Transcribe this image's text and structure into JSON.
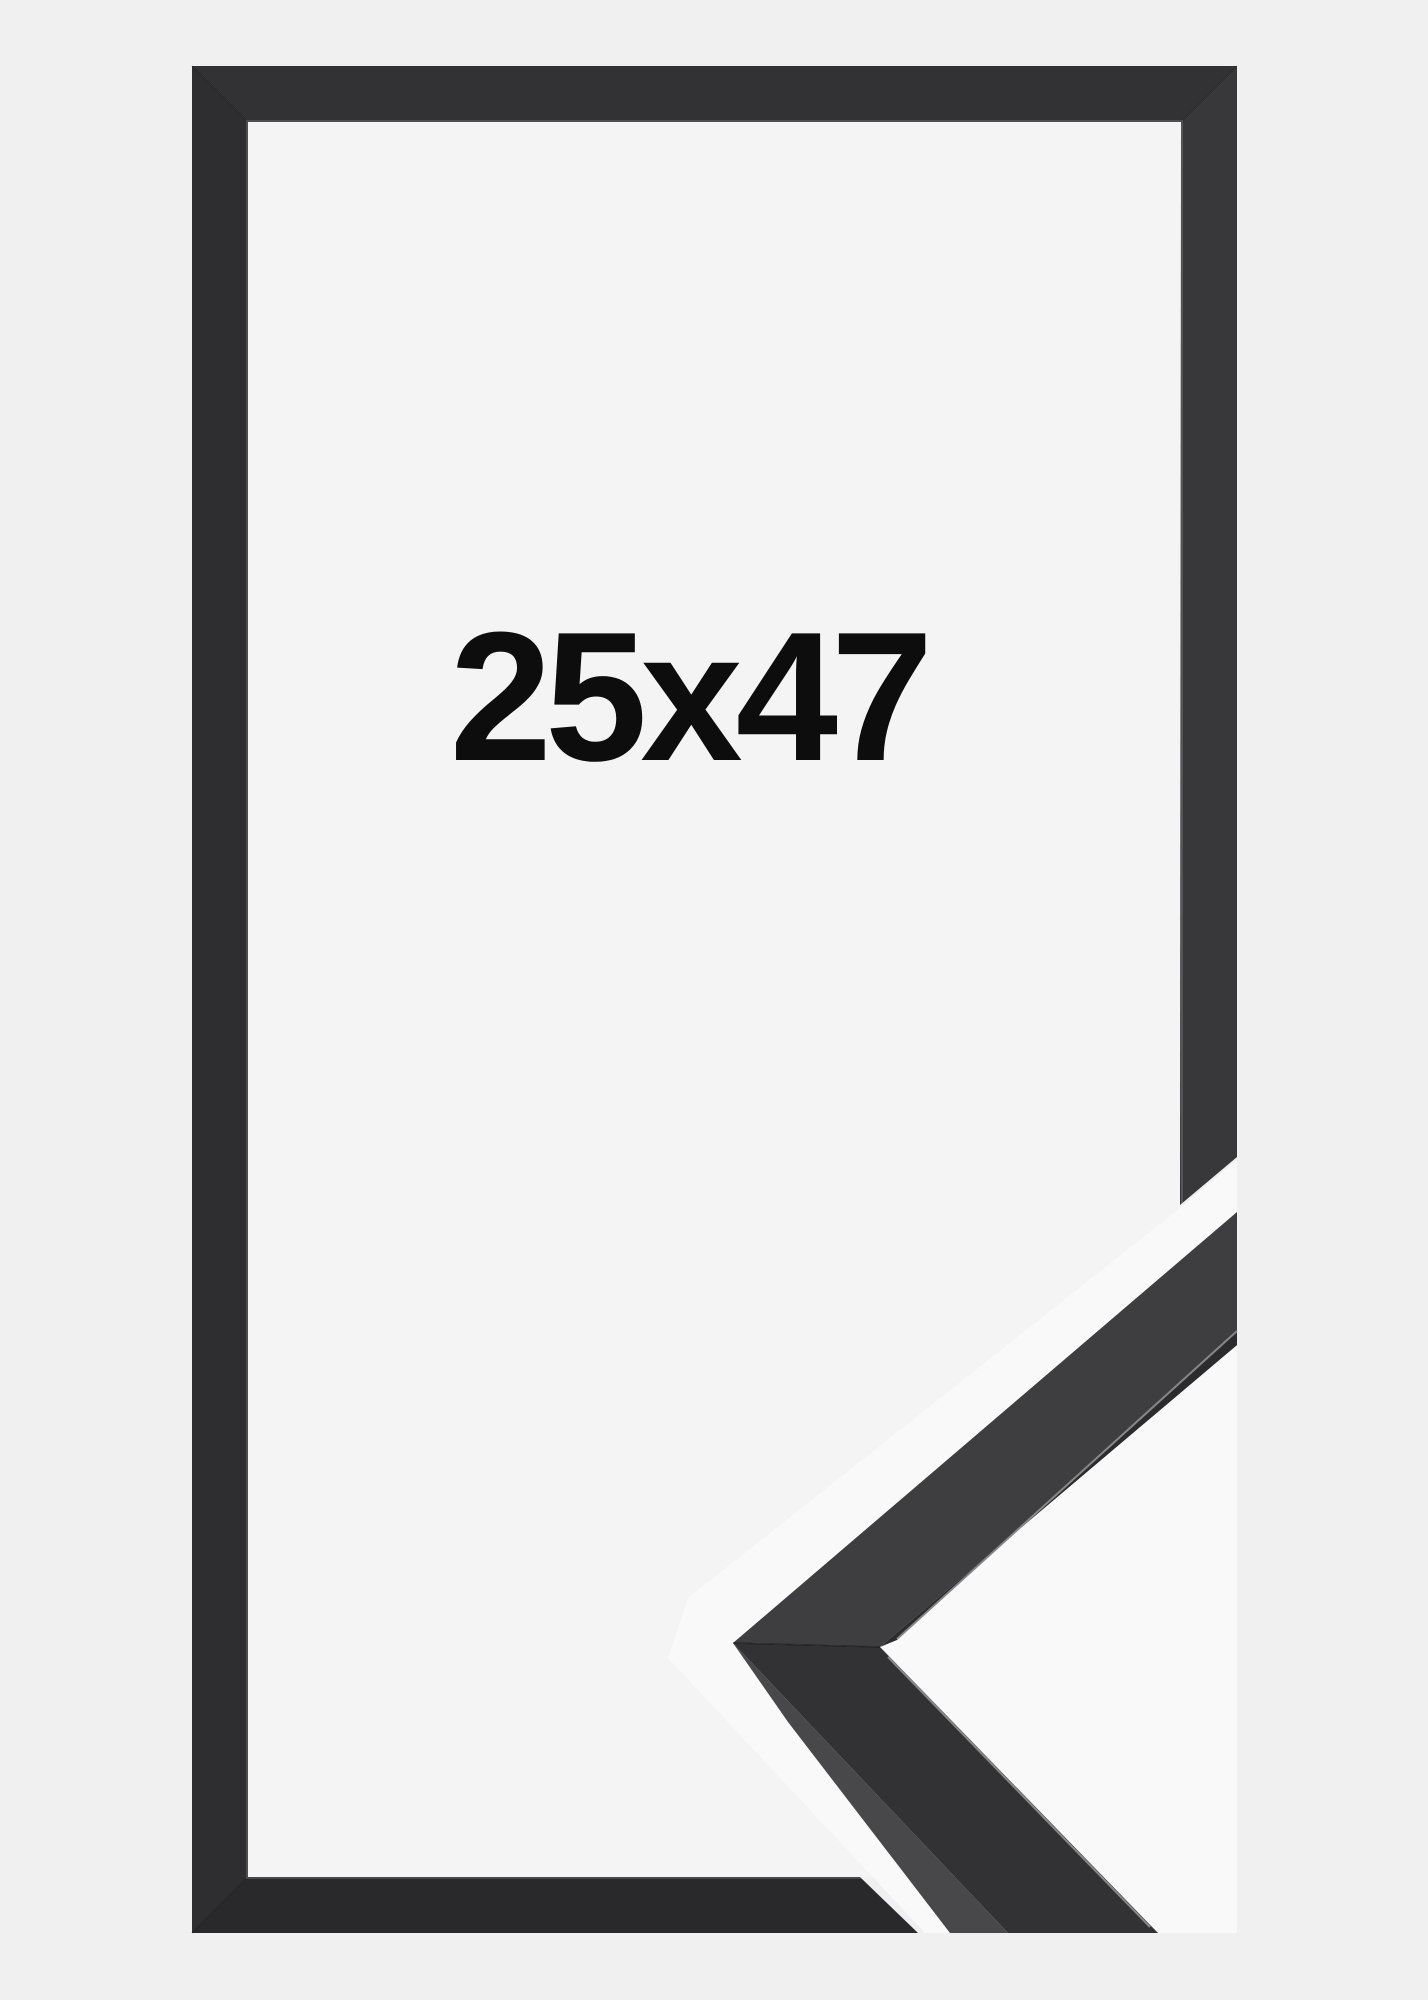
{
  "product_image": {
    "size_label": "25x47"
  },
  "colors": {
    "page_background": "#f0f0f0",
    "frame_interior": "#f4f4f4",
    "frame_top_bar": "#323234",
    "frame_left_bar": "#2e2e30",
    "frame_right_bar": "#38383a",
    "frame_bottom_bar": "#29292b",
    "detail_halo": "#f9f9f9",
    "detail_face_upper": "#3e3e40",
    "detail_face_lower": "#323234",
    "detail_side_face": "#48484a",
    "detail_inner_lip": "#2c2c2e",
    "label_text": "#0d0d0d"
  }
}
